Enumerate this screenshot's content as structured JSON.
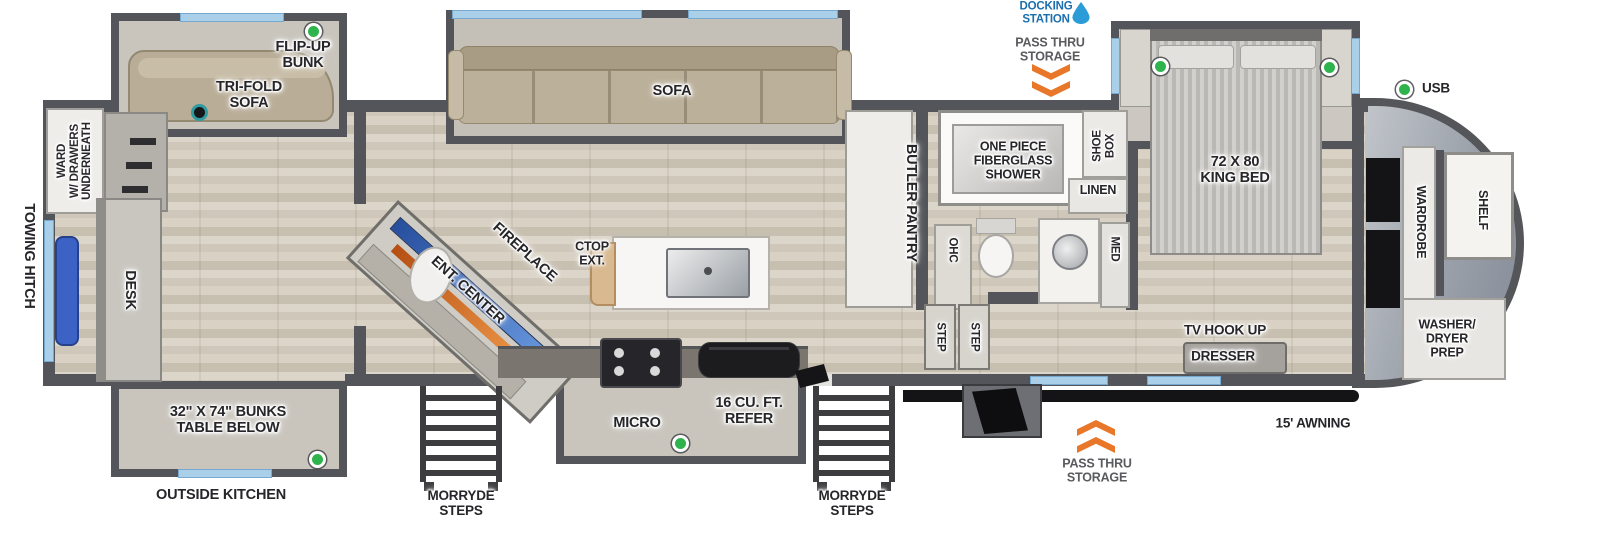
{
  "colors": {
    "wall": "#54555a",
    "floor_wood": "#d5cec1",
    "window_blue": "#a9cfe9",
    "slide_floor": "#c9c5bd",
    "indicator_green": "#2fb34d",
    "chevron_orange": "#e8772a",
    "docking_blue": "#1b6fad",
    "awning_black": "#141416",
    "chair_blue": "#3b62c4",
    "tv_strip_blue": "#3a6fc4",
    "fireplace_orange": "#e0762a",
    "sofa_tan": "#b9ad97"
  },
  "labels": {
    "towing_hitch": "TOWING HITCH",
    "ward": "WARD\nW/ DRAWERS\nUNDERNEATH",
    "desk": "DESK",
    "flip_up_bunk": "FLIP-UP\nBUNK",
    "tri_fold_sofa": "TRI-FOLD\nSOFA",
    "bunks": "32\" X 74\" BUNKS\nTABLE BELOW",
    "outside_kitchen": "OUTSIDE KITCHEN",
    "morryde_steps_left": "MORRYDE\nSTEPS",
    "morryde_steps_right": "MORRYDE\nSTEPS",
    "sofa": "SOFA",
    "fireplace": "FIREPLACE",
    "ent_center": "ENT. CENTER",
    "ctop_ext": "CTOP\nEXT.",
    "micro": "MICRO",
    "refer": "16 CU. FT.\nREFER",
    "butler_pantry": "BUTLER PANTRY",
    "shower": "ONE PIECE\nFIBERGLASS\nSHOWER",
    "shoe_box": "SHOE\nBOX",
    "linen": "LINEN",
    "ohc": "OHC",
    "med": "MED",
    "step_a": "STEP",
    "step_b": "STEP",
    "king_bed": "72 X 80\nKING BED",
    "tv_hook_up": "TV HOOK UP",
    "dresser": "DRESSER",
    "wardrobe": "WARDROBE",
    "shelf": "SHELF",
    "washer_dryer_prep": "WASHER/\nDRYER\nPREP",
    "usb": "USB",
    "docking_station": "DOCKING\nSTATION",
    "pass_thru_top": "PASS THRU\nSTORAGE",
    "pass_thru_bottom": "PASS THRU\nSTORAGE",
    "awning": "15' AWNING"
  }
}
